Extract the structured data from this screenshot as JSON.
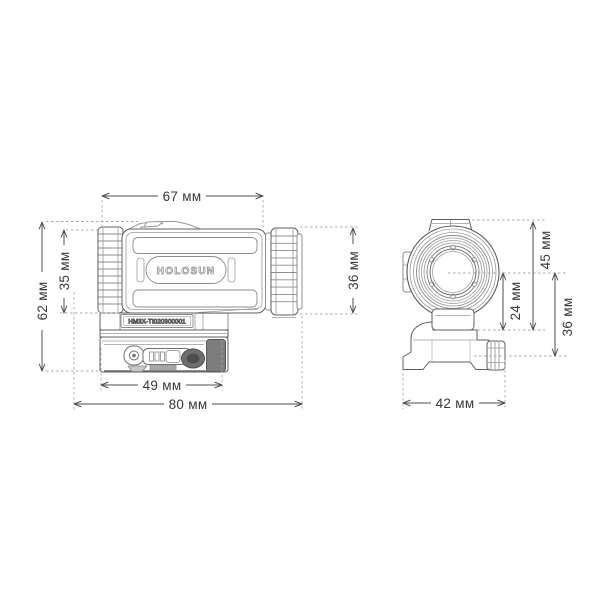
{
  "diagram": {
    "title": "magnifier-dimension-drawing",
    "unit": "мм",
    "brand_logo": "HOLOSUN",
    "serial_number": "HM3X-TI020300001",
    "colors": {
      "line": "#5f5f5f",
      "light_line": "#979797",
      "dim_line": "#4f4f4f",
      "extension_line": "#a8a8a8",
      "text": "#383838",
      "dark_fill": "#787878",
      "background": "#ffffff"
    },
    "side_view": {
      "dimensions": {
        "body_length": {
          "label": "67 мм",
          "value": 67
        },
        "total_height": {
          "label": "62 мм",
          "value": 62
        },
        "body_height": {
          "label": "35 мм",
          "value": 35
        },
        "objective_height": {
          "label": "36 мм",
          "value": 36
        },
        "mount_length": {
          "label": "49 мм",
          "value": 49
        },
        "total_length": {
          "label": "80 мм",
          "value": 80
        }
      }
    },
    "front_view": {
      "dimensions": {
        "top_to_rail_height": {
          "label": "45 мм",
          "value": 45
        },
        "axis_to_rail_height": {
          "label": "24 мм",
          "value": 24
        },
        "axis_to_base_height": {
          "label": "36 мм",
          "value": 36
        },
        "total_width": {
          "label": "42 мм",
          "value": 42
        }
      }
    }
  }
}
